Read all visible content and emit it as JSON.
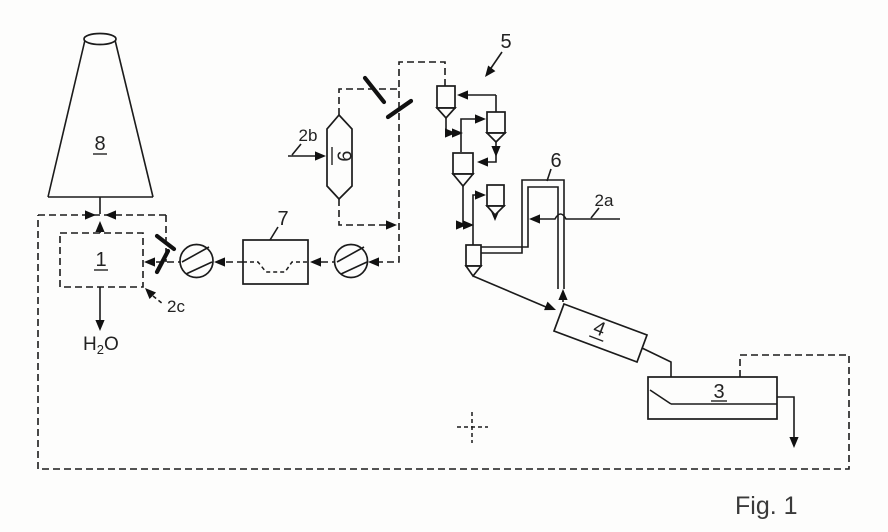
{
  "figure": {
    "caption": "Fig. 1"
  },
  "labels": {
    "stack": "8",
    "scrubber": "1",
    "cooler": "3",
    "kiln": "4",
    "preheater": "5",
    "riser_duct": "6",
    "heat_exchanger": "7",
    "conditioning_vessel": "9",
    "fuel_inlet": "2a",
    "feed_inlet": "2b",
    "branch_damper": "2c",
    "h2o_h": "H",
    "h2o_sub": "2",
    "h2o_o": "O"
  },
  "colors": {
    "line": "#1b1b1b",
    "background": "#fdfdfc",
    "text": "#222222"
  }
}
